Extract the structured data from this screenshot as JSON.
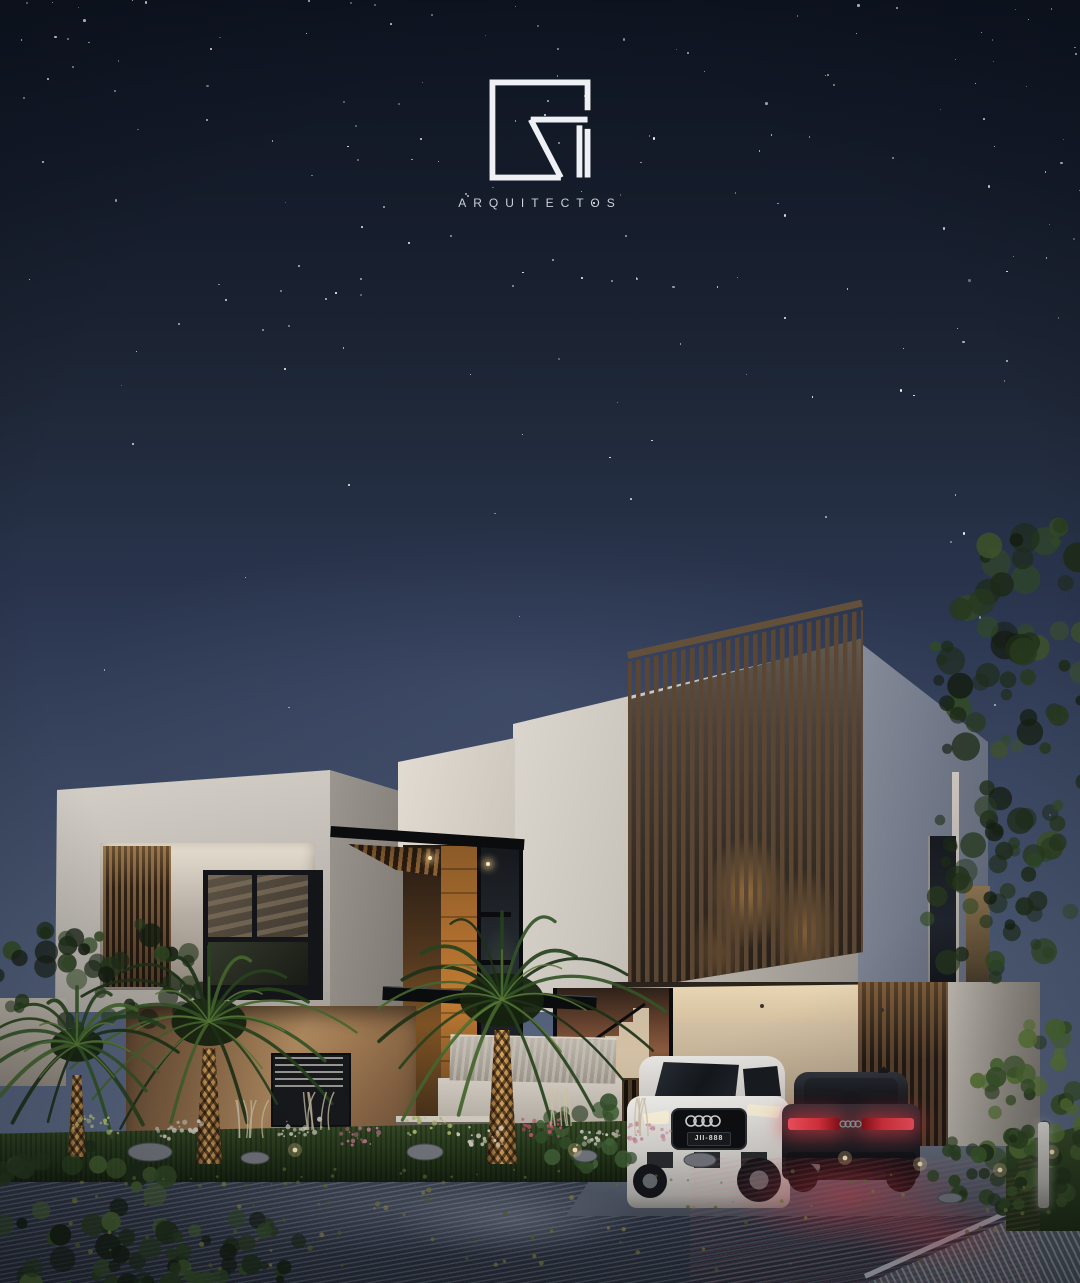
{
  "brand": {
    "monogram": "GM",
    "subtitle": "ARQUITECTOS"
  },
  "vehicles": {
    "suv_license_plate": "JII-888"
  },
  "scene": {
    "star_count": 175,
    "description_time": "night"
  },
  "palette": {
    "sky_top": "#0e1420",
    "sky_horizon": "#5d6b86",
    "wall_light": "#d8d3cb",
    "wall_shade": "#a8a39b",
    "wall_side": "#767d8b",
    "wood_slat": "#5b4634",
    "wood_warm": "#b06f2e",
    "stucco": "#a37c53",
    "canopy_black": "#0b0c0e",
    "stone": "#b2aca2",
    "glass_dark": "#15181c",
    "grass": "#2c3d20",
    "frond": "#2f4d24",
    "trunk_lit": "#d9a75e",
    "taillight_red": "#e2333e",
    "headlight": "#fff6dd",
    "road": "#3a4150",
    "star": "#ffffff"
  }
}
